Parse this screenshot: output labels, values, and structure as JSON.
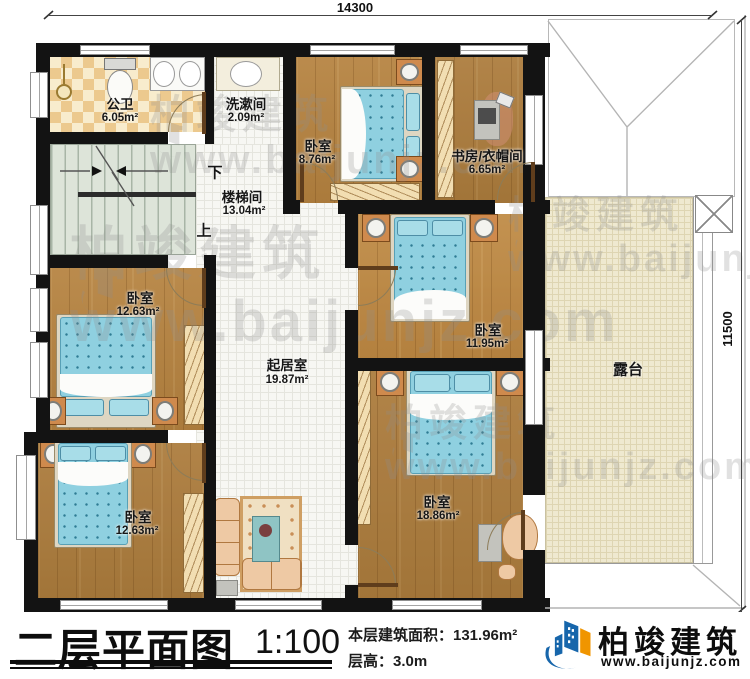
{
  "dimensions": {
    "width_top": "14300",
    "height_right": "11500"
  },
  "rooms": [
    {
      "name": "公卫",
      "area": "6.05m²"
    },
    {
      "name": "洗漱间",
      "area": "2.09m²"
    },
    {
      "name": "卧室",
      "area": "8.76m²"
    },
    {
      "name": "书房/衣帽间",
      "area": "6.65m²"
    },
    {
      "name": "楼梯间",
      "area": "13.04m²"
    },
    {
      "name": "卧室",
      "area": "12.63m²"
    },
    {
      "name": "起居室",
      "area": "19.87m²"
    },
    {
      "name": "卧室",
      "area": "11.95m²"
    },
    {
      "name": "露台",
      "area": ""
    },
    {
      "name": "卧室",
      "area": "12.63m²"
    },
    {
      "name": "卧室",
      "area": "18.86m²"
    }
  ],
  "stairs": {
    "down": "下",
    "up": "上"
  },
  "title_block": {
    "title": "二层平面图",
    "scale": "1:100",
    "floor_area": "本层建筑面积：131.96m²",
    "floor_height": "层高：3.0m"
  },
  "logo": {
    "name": "柏竣建筑",
    "site": "www.baijunjz.com"
  },
  "watermark": {
    "brand": "柏竣建筑",
    "site": "www.baijunjz.com"
  },
  "colors": {
    "brand_blue": "#1766ab",
    "brand_orange": "#f09500",
    "wall": "#131313",
    "wood": "#b5823f",
    "mattress": "#8fd0e0"
  }
}
